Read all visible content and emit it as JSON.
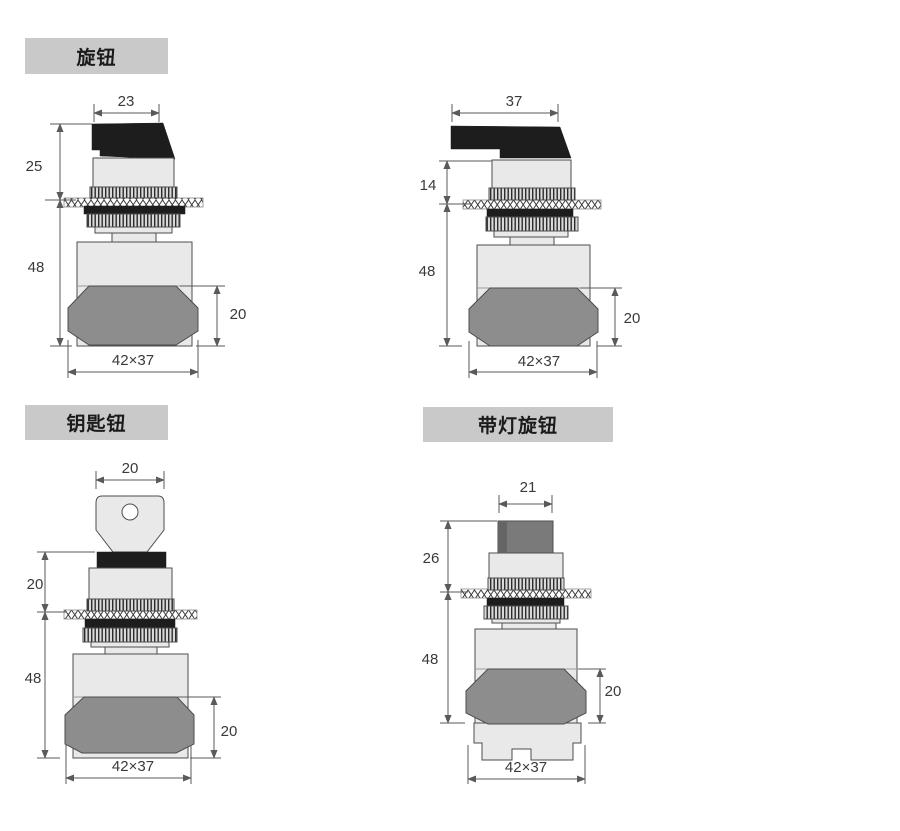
{
  "titles": {
    "knob": "旋钮",
    "key": "钥匙钮",
    "illuminated": "带灯旋钮"
  },
  "figures": {
    "knob_short": {
      "top_width": "23",
      "upper_height": "25",
      "body_height": "48",
      "boot_height": "20",
      "mount_size": "42×37"
    },
    "knob_long": {
      "top_width": "37",
      "upper_height": "14",
      "body_height": "48",
      "boot_height": "20",
      "mount_size": "42×37"
    },
    "key_button": {
      "top_width": "20",
      "upper_height": "20",
      "body_height": "48",
      "boot_height": "20",
      "mount_size": "42×37"
    },
    "illuminated_knob": {
      "top_width": "21",
      "upper_height": "26",
      "body_height": "48",
      "boot_height": "20",
      "mount_size": "42×37"
    }
  },
  "colors": {
    "title-bg": "#c9c9c9",
    "title-text": "#1a1a1a",
    "part-dark": "#1d1d1d",
    "part-light": "#e9e9e9",
    "boot": "#8d8d8d",
    "knob": "#7a7a7a",
    "outline": "#4d4d4d",
    "dim-line": "#5a5a5a",
    "dim-text": "#3a3a3a",
    "page-bg": "#ffffff"
  }
}
